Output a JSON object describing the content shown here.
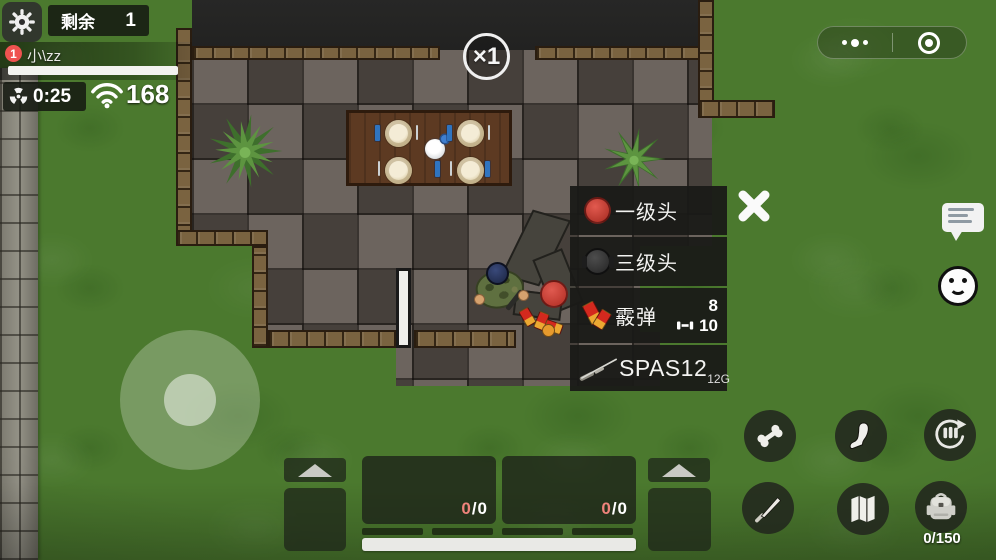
{
  "hud": {
    "remaining_label": "剩余",
    "remaining_value": "1",
    "player": {
      "badge": "1",
      "name": "小\\zz",
      "health_percent": 100
    },
    "radiation_time": "0:25",
    "signal_strength": "168",
    "speed_badge": "×1"
  },
  "capsule": {
    "icons": [
      "menu-dots",
      "record-circle"
    ]
  },
  "side_icons": [
    "chat-bubble",
    "smiley-emote"
  ],
  "loot_panel": {
    "close_icon": "x-close",
    "items": [
      {
        "label": "一级头",
        "icon": "helmet-level1-red"
      },
      {
        "label": "三级头",
        "icon": "helmet-level3-dark"
      },
      {
        "label": "霰弹",
        "icon": "shotgun-shells",
        "count": "8",
        "capacity": "10",
        "mag_icon": "ammo-bullet"
      },
      {
        "label": "SPAS12",
        "icon": "shotgun",
        "caliber": "12G"
      }
    ]
  },
  "inventory": {
    "slot1": {
      "current": "0",
      "rest": "/0"
    },
    "slot2": {
      "current": "0",
      "rest": "/0"
    }
  },
  "actions": {
    "icons": [
      "bone",
      "foot",
      "reload-ammo",
      "knife",
      "map",
      "backpack"
    ],
    "backpack_count": "0/150"
  },
  "colors": {
    "grass": "#4b792e",
    "panel_bg": "#191917",
    "accent_red": "#ef5350",
    "ammo_red": "#ef837b",
    "hud_text": "#ffffff"
  }
}
